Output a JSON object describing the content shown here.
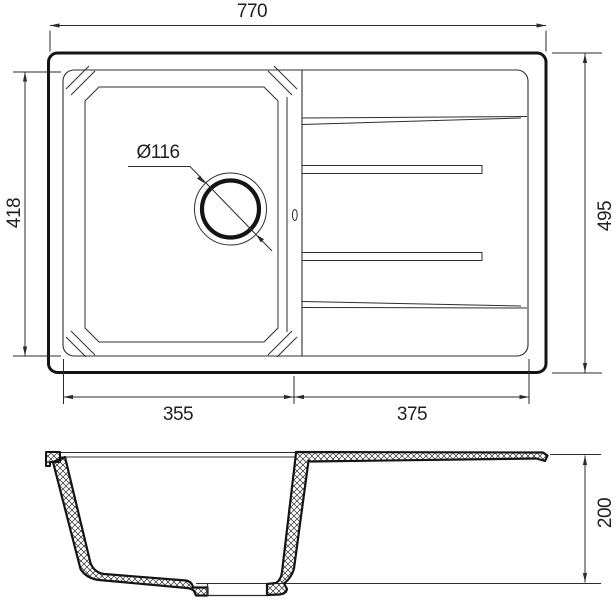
{
  "drawing": {
    "background": "#ffffff",
    "thick_line_color": "#141414",
    "thin_line_color": "#2e2e2e",
    "labels": {
      "overall_width": "770",
      "overall_depth": "495",
      "bowl_length": "418",
      "bowl_width": "355",
      "drainboard_width": "375",
      "drain_diameter": "Ø116",
      "bowl_depth": "200"
    }
  }
}
